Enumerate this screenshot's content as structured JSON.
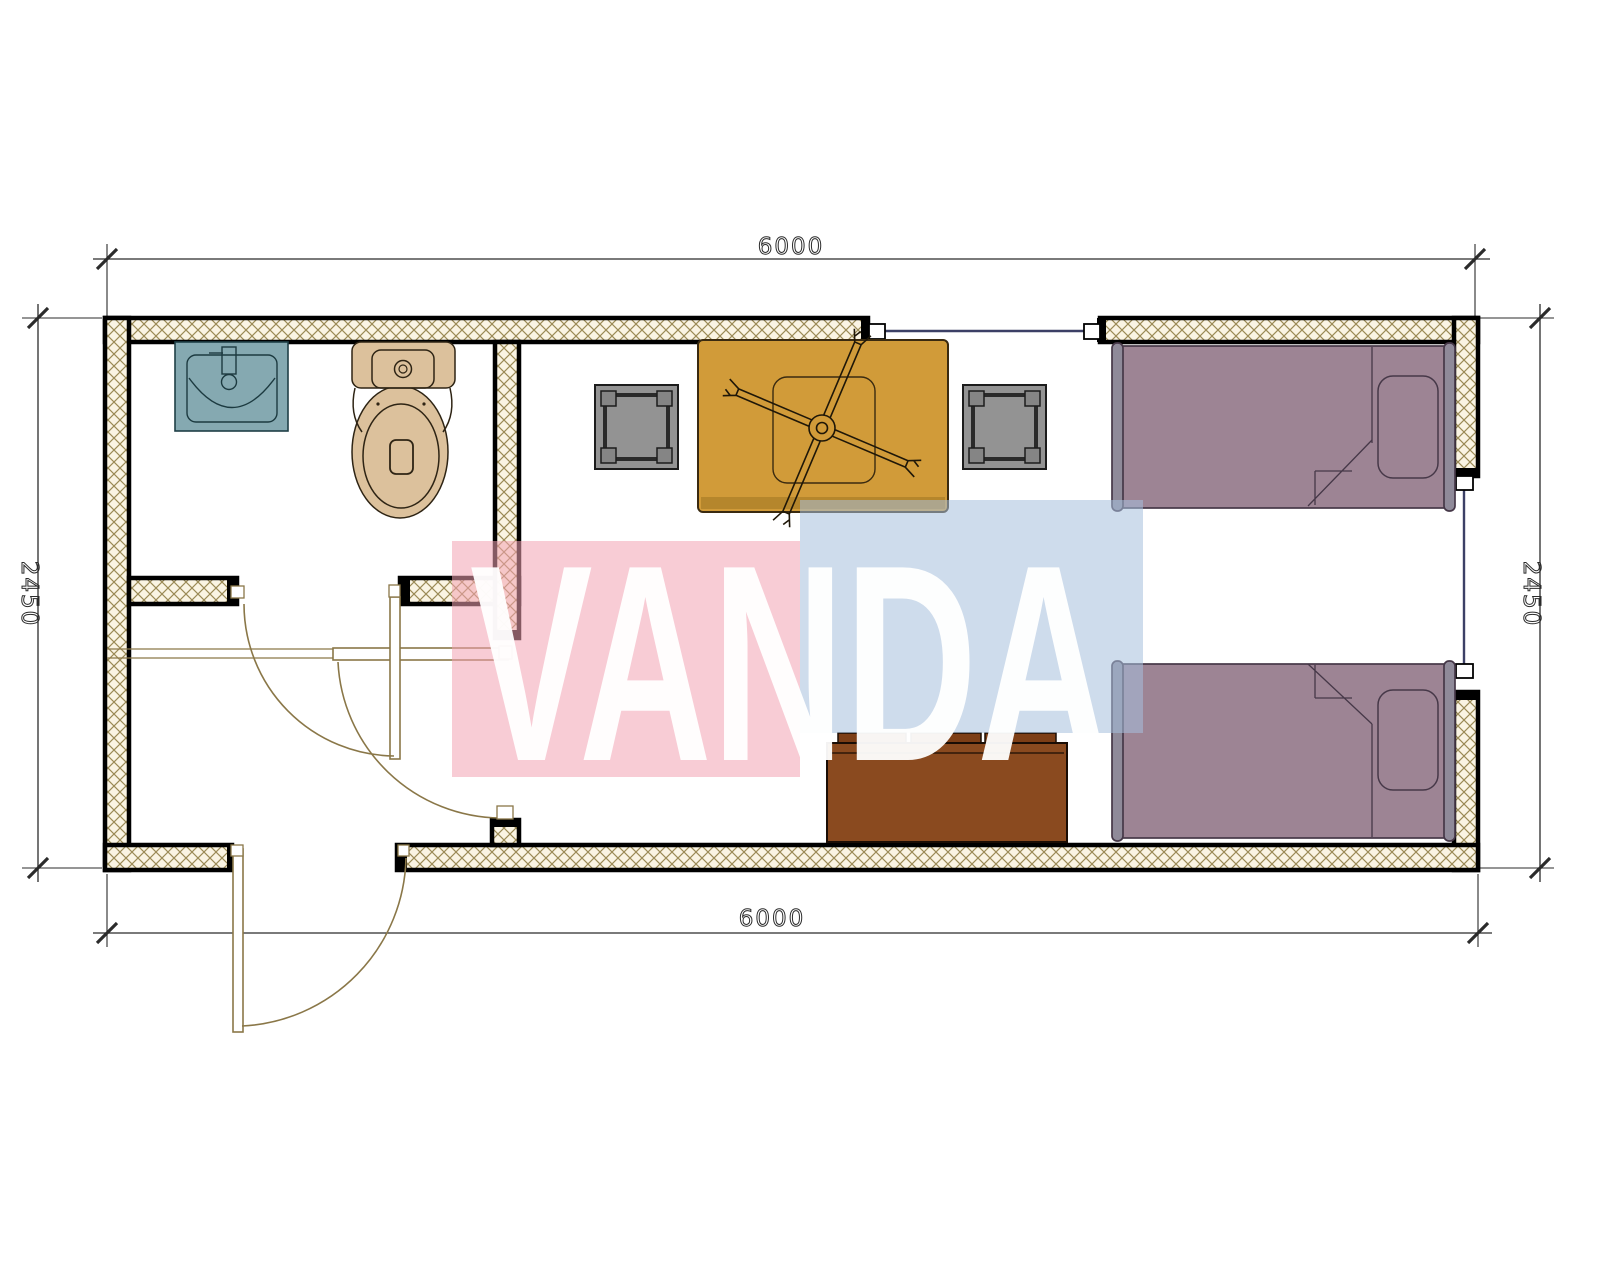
{
  "dimensions": {
    "top": "6000",
    "bottom": "6000",
    "left": "2450",
    "right": "2450"
  },
  "watermark": {
    "text": "VANDA",
    "pink": "#f2a2b2",
    "blue": "#a6c0dc",
    "text_color": "#ffffff"
  },
  "colors": {
    "wall_fill": "#faf4e3",
    "hatch_line": "#9b8a56",
    "wall_edge": "#000000",
    "window_line": "#3c4066",
    "door_line": "#8a7748",
    "dim": "#2b2b2b",
    "sink_fill": "#85a9b1",
    "sink_line": "#1f3f46",
    "toilet_fill": "#dcc19c",
    "toilet_line": "#2e2414",
    "stool_fill": "#939393",
    "stool_leg": "#858585",
    "table_fill": "#d19b39",
    "table_edge": "#b5862c",
    "table_line": "#3a2a10",
    "bed_fill": "#9d8494",
    "bed_rail": "#8f8a99",
    "bed_line": "#463848",
    "sofa_fill": "#8a4a1f",
    "sofa_cushion": "#7d3e16",
    "sofa_line": "#1a0d05"
  }
}
